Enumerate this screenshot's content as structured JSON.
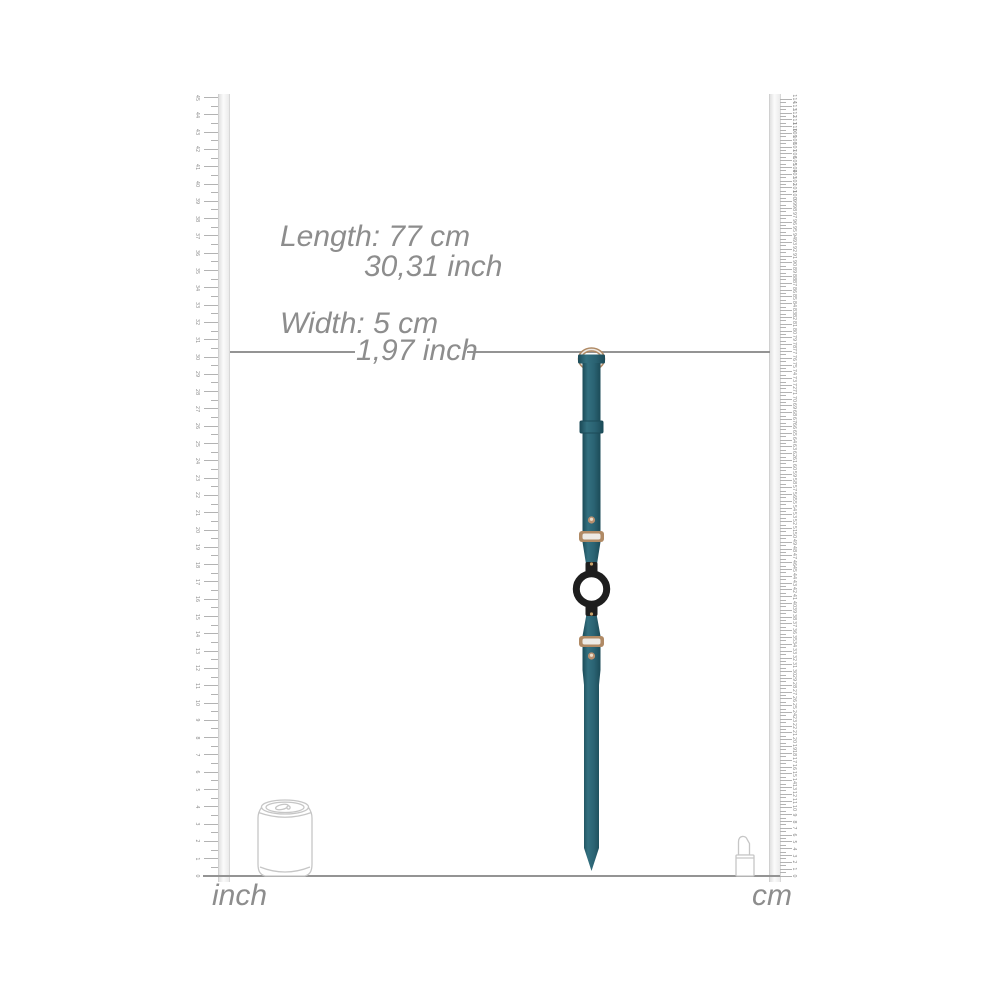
{
  "annotations": {
    "length": {
      "metric": "Length: 77 cm",
      "imperial": "30,31 inch"
    },
    "width": {
      "metric": "Width: 5 cm",
      "imperial": "1,97 inch"
    }
  },
  "rulers": {
    "baseline_y": 876,
    "left": {
      "unit_label": "inch",
      "min": 0,
      "max": 45,
      "px_per_unit": 17.3,
      "half_ticks": true
    },
    "right": {
      "unit_label": "cm",
      "min": 0,
      "max": 114,
      "px_per_unit": 6.812,
      "half_ticks": true
    }
  },
  "product": {
    "name": "teal strap with black o-ring",
    "length_cm": "77",
    "length_inch": "30,31",
    "width_cm": "5",
    "width_inch": "1,97"
  },
  "reference_objects": {
    "left": "soda-can",
    "right": "lipstick"
  },
  "colors": {
    "strap": "#2a6272",
    "strap_light": "#33707f",
    "strap_dark": "#1c4b58",
    "ring_black": "#1e1e1e",
    "metal_rose": "#b08a65",
    "metal_light": "#edeae5",
    "rivet": "#b98f6e",
    "rivet_highlight": "#ecdfcd",
    "gold_pin": "#c9a36b",
    "text_gray": "#8d8d8d",
    "line_gray": "#949494",
    "ruler_tick": "#b3b3b3",
    "ruler_number": "#8f8f8f",
    "outline_gray": "#c6c6c6"
  }
}
